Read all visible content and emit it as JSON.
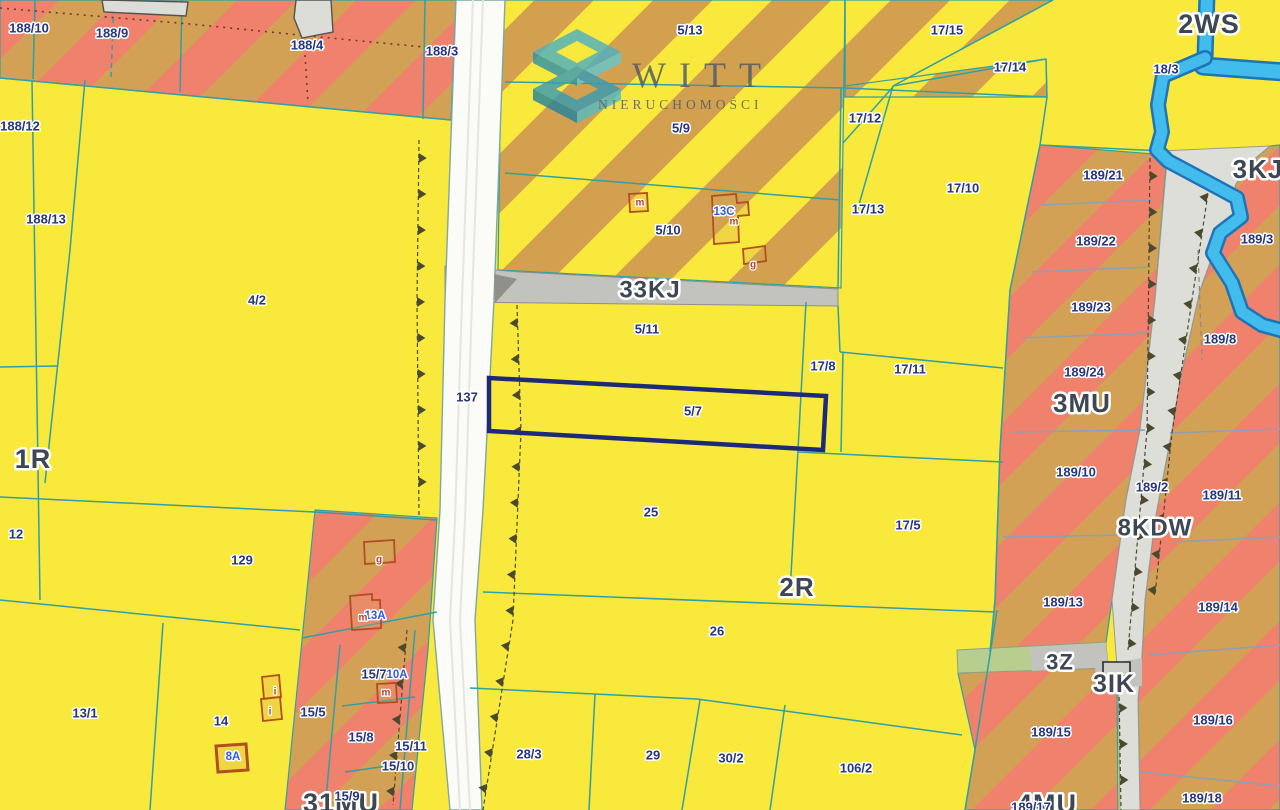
{
  "watermark": {
    "title": "WITT",
    "subtitle": "NIERUCHOMOŚCI"
  },
  "selected_parcel": {
    "parcel": "5/7"
  },
  "colors": {
    "yellow": "#F9E93C",
    "stripe_salmon": "#F0816D",
    "stripe_tan": "#D2A156",
    "stripe_gold": "#D2A04E",
    "road_white": "#FBFBF7",
    "road_gray": "#C2C2BE",
    "road_gray_light": "#DEDED9",
    "road_dark_wedge": "#90908B",
    "green_strip": "#B7CE8F",
    "water": "#42BCEC",
    "water_edge": "#1F74B8",
    "parcel_line": "#2FA0A5",
    "zone_line": "#8FA0B2",
    "tick": "#4A4A30",
    "dotted": "#6E3B30",
    "label_navy": "#26357E",
    "label_zone": "#3D4753",
    "label_blue": "#2E5BEA",
    "label_red": "#C03A28",
    "selected": "#1D2A7A",
    "building_fill": "#DCDCD8",
    "building_outline": "#55524E",
    "red_outline": "#B05020",
    "watermark_text": "#4E5A66"
  },
  "labels": {
    "zones": [
      {
        "text": "2WS",
        "x": 1209,
        "y": 24,
        "size": 27
      },
      {
        "text": "3KJ",
        "x": 1258,
        "y": 169,
        "size": 26
      },
      {
        "text": "3MU",
        "x": 1082,
        "y": 403,
        "size": 26
      },
      {
        "text": "8KDW",
        "x": 1155,
        "y": 528,
        "size": 24
      },
      {
        "text": "2R",
        "x": 797,
        "y": 587,
        "size": 26
      },
      {
        "text": "1R",
        "x": 33,
        "y": 459,
        "size": 27
      },
      {
        "text": "33KJ",
        "x": 650,
        "y": 290,
        "size": 24
      },
      {
        "text": "3Z",
        "x": 1060,
        "y": 662,
        "size": 22
      },
      {
        "text": "3IK",
        "x": 1114,
        "y": 684,
        "size": 25
      },
      {
        "text": "31MU",
        "x": 341,
        "y": 803,
        "size": 27
      },
      {
        "text": "4MU",
        "x": 1047,
        "y": 804,
        "size": 27
      }
    ],
    "parcels": [
      {
        "text": "188/10",
        "x": 29,
        "y": 28
      },
      {
        "text": "188/9",
        "x": 112,
        "y": 33
      },
      {
        "text": "188/4",
        "x": 307,
        "y": 45
      },
      {
        "text": "188/3",
        "x": 442,
        "y": 51
      },
      {
        "text": "188/12",
        "x": 20,
        "y": 126
      },
      {
        "text": "188/13",
        "x": 46,
        "y": 219
      },
      {
        "text": "4/2",
        "x": 257,
        "y": 300
      },
      {
        "text": "12",
        "x": 16,
        "y": 534
      },
      {
        "text": "129",
        "x": 242,
        "y": 560
      },
      {
        "text": "13/1",
        "x": 85,
        "y": 713
      },
      {
        "text": "14",
        "x": 221,
        "y": 721
      },
      {
        "text": "137",
        "x": 467,
        "y": 397
      },
      {
        "text": "5/13",
        "x": 690,
        "y": 30
      },
      {
        "text": "5/9",
        "x": 681,
        "y": 128
      },
      {
        "text": "5/10",
        "x": 668,
        "y": 230
      },
      {
        "text": "5/11",
        "x": 647,
        "y": 329
      },
      {
        "text": "5/7",
        "x": 693,
        "y": 411
      },
      {
        "text": "17/15",
        "x": 947,
        "y": 30
      },
      {
        "text": "17/14",
        "x": 1010,
        "y": 67
      },
      {
        "text": "17/12",
        "x": 865,
        "y": 118
      },
      {
        "text": "17/13",
        "x": 868,
        "y": 209
      },
      {
        "text": "17/10",
        "x": 963,
        "y": 188
      },
      {
        "text": "18/3",
        "x": 1166,
        "y": 69
      },
      {
        "text": "17/8",
        "x": 823,
        "y": 366
      },
      {
        "text": "17/11",
        "x": 910,
        "y": 369
      },
      {
        "text": "17/5",
        "x": 908,
        "y": 525
      },
      {
        "text": "25",
        "x": 651,
        "y": 512
      },
      {
        "text": "26",
        "x": 717,
        "y": 631
      },
      {
        "text": "28/3",
        "x": 529,
        "y": 754
      },
      {
        "text": "29",
        "x": 653,
        "y": 755
      },
      {
        "text": "30/2",
        "x": 731,
        "y": 758
      },
      {
        "text": "106/2",
        "x": 856,
        "y": 768
      },
      {
        "text": "189/21",
        "x": 1103,
        "y": 175
      },
      {
        "text": "189/22",
        "x": 1096,
        "y": 241
      },
      {
        "text": "189/23",
        "x": 1091,
        "y": 307
      },
      {
        "text": "189/24",
        "x": 1084,
        "y": 372
      },
      {
        "text": "189/3",
        "x": 1257,
        "y": 239
      },
      {
        "text": "189/8",
        "x": 1220,
        "y": 339
      },
      {
        "text": "189/10",
        "x": 1076,
        "y": 472
      },
      {
        "text": "189/2",
        "x": 1152,
        "y": 487
      },
      {
        "text": "189/11",
        "x": 1222,
        "y": 495
      },
      {
        "text": "189/13",
        "x": 1063,
        "y": 602
      },
      {
        "text": "189/14",
        "x": 1218,
        "y": 607
      },
      {
        "text": "189/15",
        "x": 1051,
        "y": 732
      },
      {
        "text": "189/16",
        "x": 1213,
        "y": 720
      },
      {
        "text": "189/18",
        "x": 1202,
        "y": 798
      },
      {
        "text": "189/17",
        "x": 1031,
        "y": 807
      },
      {
        "text": "15/5",
        "x": 313,
        "y": 712
      },
      {
        "text": "15/7",
        "x": 374,
        "y": 674
      },
      {
        "text": "15/8",
        "x": 361,
        "y": 737
      },
      {
        "text": "15/11",
        "x": 411,
        "y": 746
      },
      {
        "text": "15/10",
        "x": 398,
        "y": 766
      },
      {
        "text": "15/9",
        "x": 347,
        "y": 796
      }
    ],
    "addresses": [
      {
        "text": "13C",
        "x": 724,
        "y": 212
      },
      {
        "text": "13A",
        "x": 375,
        "y": 616
      },
      {
        "text": "10A",
        "x": 397,
        "y": 675
      },
      {
        "text": "8A",
        "x": 233,
        "y": 757
      }
    ],
    "letters": [
      {
        "text": "m",
        "x": 640,
        "y": 203
      },
      {
        "text": "m",
        "x": 734,
        "y": 222
      },
      {
        "text": "g",
        "x": 753,
        "y": 265
      },
      {
        "text": "g",
        "x": 379,
        "y": 560
      },
      {
        "text": "m",
        "x": 363,
        "y": 618
      },
      {
        "text": "m",
        "x": 386,
        "y": 693
      },
      {
        "text": "i",
        "x": 275,
        "y": 692
      },
      {
        "text": "i",
        "x": 270,
        "y": 712
      }
    ]
  }
}
